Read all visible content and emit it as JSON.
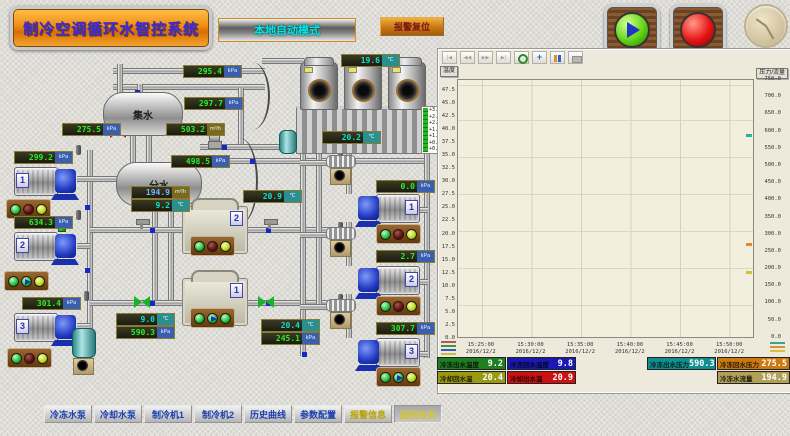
{
  "header": {
    "title": "制冷空调循环水智控系统",
    "mode": "本地自动模式",
    "alarm_reset": "报警复位"
  },
  "process": {
    "tanks": {
      "collector": "集水",
      "divider": "分水"
    },
    "level_scale": [
      "+3.00",
      "+2.50",
      "+2.00",
      "+1.50",
      "+1.00",
      "+0.50",
      "+0.00"
    ],
    "chilled_pumps": [
      {
        "number": "1",
        "lights": [
          "green",
          "red",
          "yellow"
        ]
      },
      {
        "number": "2",
        "lights": [
          "green",
          "run",
          "yellow"
        ]
      },
      {
        "number": "3",
        "lights": [
          "green",
          "red",
          "yellow"
        ]
      }
    ],
    "cooling_pumps": [
      {
        "number": "1",
        "lights": [
          "green",
          "red",
          "yellow"
        ]
      },
      {
        "number": "2",
        "lights": [
          "green",
          "red",
          "yellow"
        ]
      },
      {
        "number": "3",
        "lights": [
          "green",
          "run",
          "yellow"
        ]
      }
    ],
    "chillers": [
      {
        "number": "1",
        "lights": [
          "green",
          "run",
          "green"
        ]
      },
      {
        "number": "2",
        "lights": [
          "green",
          "red",
          "yellow"
        ]
      }
    ]
  },
  "displays": {
    "collector_pressure": {
      "value": "275.5",
      "unit": "kPa"
    },
    "chilled_pump1_pressure": {
      "value": "299.2",
      "unit": "kPa"
    },
    "chilled_pump2_pressure": {
      "value": "634.3",
      "unit": "kPa"
    },
    "chilled_pump3_pressure": {
      "value": "301.4",
      "unit": "kPa"
    },
    "supply_pressure_1": {
      "value": "295.4",
      "unit": "kPa"
    },
    "supply_pressure_2": {
      "value": "297.7",
      "unit": "kPa"
    },
    "main_flow": {
      "value": "503.2",
      "unit": "m³/h"
    },
    "return_pressure": {
      "value": "498.5",
      "unit": "kPa"
    },
    "chilled_flow": {
      "value": "194.9",
      "unit": "m³/h"
    },
    "chilled_supply_temp": {
      "value": "9.2",
      "unit": "℃"
    },
    "cooling_return_temp": {
      "value": "20.9",
      "unit": "℃"
    },
    "tower_inlet_temp": {
      "value": "19.6",
      "unit": "℃"
    },
    "tower_outlet_temp": {
      "value": "20.2",
      "unit": "℃"
    },
    "cooling_pump1_pressure": {
      "value": "0.0",
      "unit": "kPa"
    },
    "cooling_pump2_pressure": {
      "value": "2.7",
      "unit": "kPa"
    },
    "cooling_pump3_pressure": {
      "value": "307.7",
      "unit": "kPa"
    },
    "chilled_return_temp": {
      "value": "9.0",
      "unit": "℃"
    },
    "chilled_main_pressure": {
      "value": "590.3",
      "unit": "kPa"
    },
    "cooling_outlet_temp": {
      "value": "20.4",
      "unit": "℃"
    },
    "cooling_main_pressure": {
      "value": "245.1",
      "unit": "kPa"
    }
  },
  "status_bar": [
    {
      "label": "冷冻出水温度",
      "value": "9.2",
      "color": "green"
    },
    {
      "label": "冷冻回水温度",
      "value": "9.8",
      "color": "blue"
    },
    {
      "label": "冷冻出水压力",
      "value": "590.3",
      "color": "teal"
    },
    {
      "label": "冷冻回水压力",
      "value": "275.5",
      "color": "orange"
    },
    {
      "label": "冷却回水温",
      "value": "20.4",
      "color": "olive"
    },
    {
      "label": "冷却出水温",
      "value": "20.9",
      "color": "red"
    },
    {
      "label": "冷冻水流量",
      "value": "194.9",
      "color": "khaki"
    }
  ],
  "nav": [
    {
      "label": "冷冻水泵"
    },
    {
      "label": "冷却水泵"
    },
    {
      "label": "制冷机1"
    },
    {
      "label": "制冷机2"
    },
    {
      "label": "历史曲线"
    },
    {
      "label": "参数配置"
    },
    {
      "label": "报警信息"
    },
    {
      "label": "返回主页"
    }
  ],
  "chart_data": {
    "type": "line",
    "title": "",
    "toolbar_icons": [
      "first",
      "prev",
      "next",
      "last",
      "zoom-in",
      "pan",
      "pause",
      "print"
    ],
    "toolbar_glyphs": {
      "first": "|◀",
      "prev": "◀◀",
      "next": "▶▶",
      "last": "▶|",
      "pan": "+"
    },
    "y_left": {
      "label": "温度",
      "range": [
        0,
        50
      ],
      "ticks": [
        "47.5",
        "45.0",
        "42.5",
        "40.0",
        "37.5",
        "35.0",
        "32.5",
        "30.0",
        "27.5",
        "25.0",
        "22.5",
        "20.0",
        "17.5",
        "15.0",
        "12.5",
        "10.0",
        "7.5",
        "5.0",
        "2.5",
        "0.0"
      ]
    },
    "y_right": {
      "label": "压力/流量",
      "range": [
        0,
        750
      ],
      "ticks": [
        "750.0",
        "700.0",
        "650.0",
        "600.0",
        "550.0",
        "500.0",
        "450.0",
        "400.0",
        "350.0",
        "300.0",
        "250.0",
        "200.0",
        "150.0",
        "100.0",
        "50.0",
        "0.0"
      ]
    },
    "x_labels": [
      "15:25:00\n2016/12/2",
      "15:30:00\n2016/12/2",
      "15:35:00\n2016/12/2",
      "15:40:00\n2016/12/2",
      "15:45:00\n2016/12/2",
      "15:50:00\n2016/12/2"
    ],
    "grid": true,
    "plot_bg": "#f2efdf",
    "series": [],
    "current_value_markers": [
      {
        "color": "#2bb09a",
        "axis": "right",
        "value": 590.3
      },
      {
        "color": "#e08a30",
        "axis": "right",
        "value": 275.5
      },
      {
        "color": "#cfc040",
        "axis": "right",
        "value": 194.9
      }
    ],
    "legend_left_colors": [
      "#b05858",
      "#3a9a3a",
      "#3a5ab8",
      "#c8c040"
    ],
    "legend_right_colors": [
      "#2aaa9a",
      "#e09030",
      "#d8c040"
    ]
  },
  "palette": {
    "accent_orange": "#e8860a",
    "digit_green": "#28ee28",
    "digit_teal": "#0de0d0",
    "lamp_green": "#17c03a",
    "lamp_red": "#5e1010",
    "lamp_yellow": "#b8d820"
  }
}
